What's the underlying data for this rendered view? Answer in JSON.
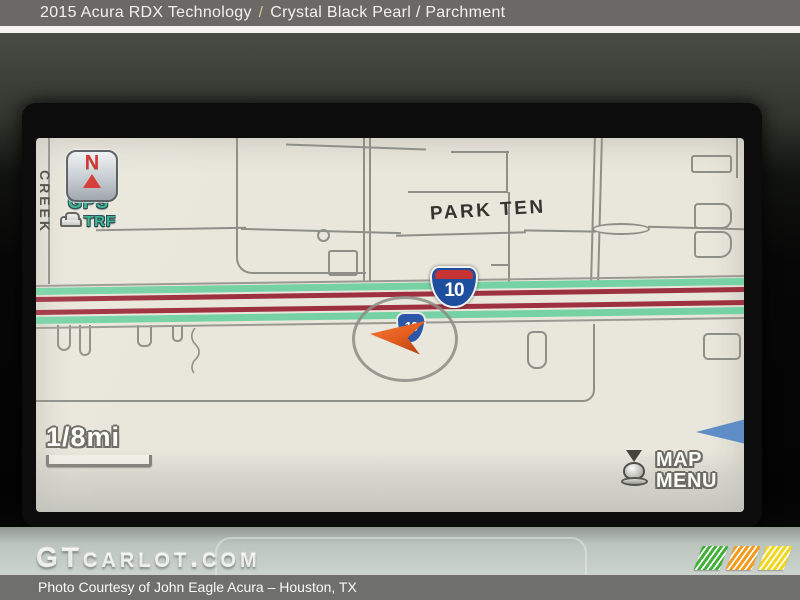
{
  "title_bar": {
    "model": "2015 Acura RDX Technology",
    "separator": "/",
    "trim": "Crystal Black Pearl / Parchment"
  },
  "nav_screen": {
    "compass": {
      "north_letter": "N"
    },
    "gps_indicator": "GPS",
    "traffic_indicator": "TRF",
    "street_label_left": "CREEK",
    "area_label": "PARK TEN",
    "interstate_shield": "10",
    "vehicle_shield": "10",
    "scale_label": "1/8mi",
    "map_menu_button": {
      "line1": "MAP",
      "line2": "MENU"
    }
  },
  "watermark": {
    "text": "GTcarlot.com"
  },
  "footer": {
    "credit": "Photo Courtesy of John Eagle Acura – Houston, TX"
  },
  "logo": {
    "stripe_colors": [
      "#44b03c",
      "#f29b1d",
      "#f0d822"
    ]
  },
  "colors": {
    "map_background": "#e9e6db",
    "traffic_green": "#76d2a4",
    "traffic_red": "#9e3140",
    "interstate_blue": "#1d4f9e",
    "interstate_red": "#c63434",
    "gps_green": "#35b288"
  }
}
